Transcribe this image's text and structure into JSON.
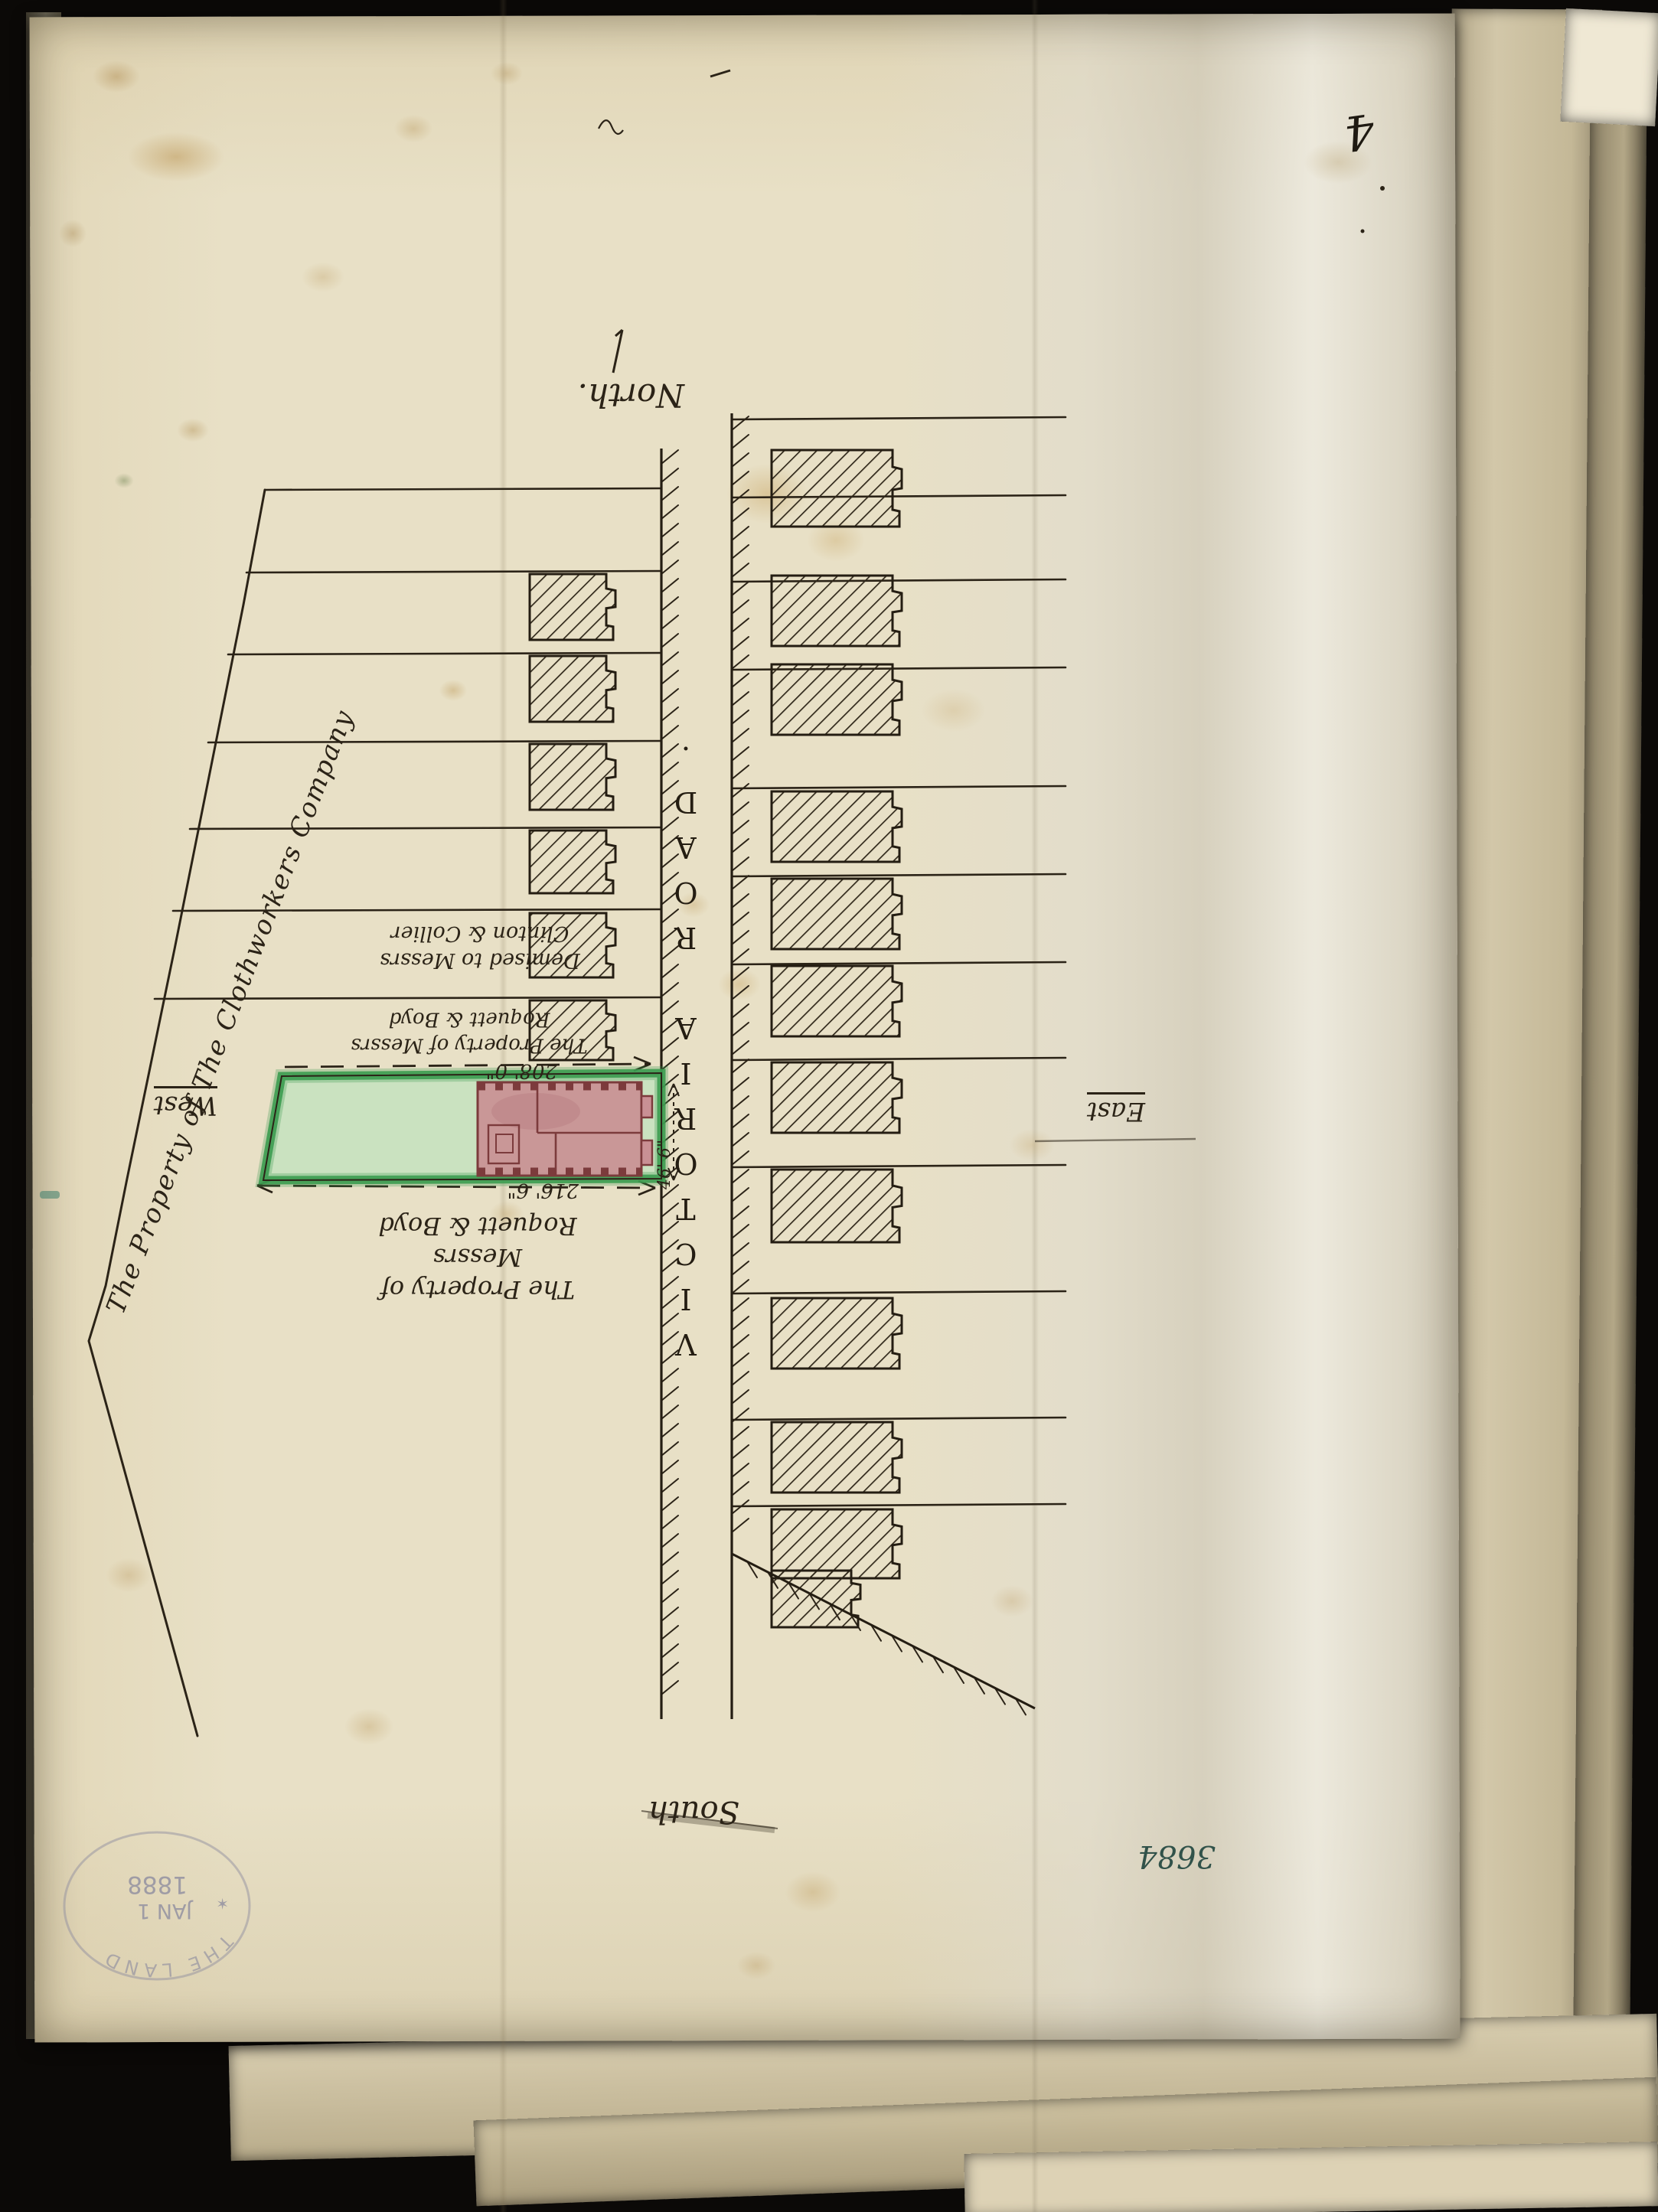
{
  "page": {
    "number": "4",
    "file_number": "3684"
  },
  "compass": {
    "north": "North.",
    "south": "South",
    "east": "East",
    "west": "West"
  },
  "road": {
    "name": "VICTORIA  ROAD."
  },
  "boundary": {
    "label": "The Property of The Clothworkers Company"
  },
  "plots": {
    "demised": {
      "line1": "Demised to Messrs",
      "line2": "Clinton & Collier"
    },
    "mid": {
      "line1": "The Property of Messrs",
      "line2": "Roquett & Boyd"
    },
    "south": {
      "line1": "The Property of Messrs",
      "line2": "Roquett & Boyd"
    }
  },
  "measurements": {
    "north_side": "208' 0\"",
    "south_side": "216' 6\"",
    "frontage": "46' 6\""
  },
  "stamp": {
    "arc_text": "THE LAND",
    "star": "✶",
    "date_line1": "JAN 1",
    "date_line2": "1888"
  },
  "colors": {
    "ink": "#2b2317",
    "plot_green": "#3f9e52",
    "plot_green_fill": "#c6e2bf",
    "building_pink": "#c99094",
    "building_outline": "#7c3b3c",
    "stamp_ink": "#8f8ea0",
    "file_ink": "#31524a",
    "paper": "#e8e0c6"
  },
  "map_features": {
    "west_building_count": 6,
    "east_building_count": 12,
    "notes": "hand-drawn estate plan, annotations rotated 180 degrees"
  }
}
